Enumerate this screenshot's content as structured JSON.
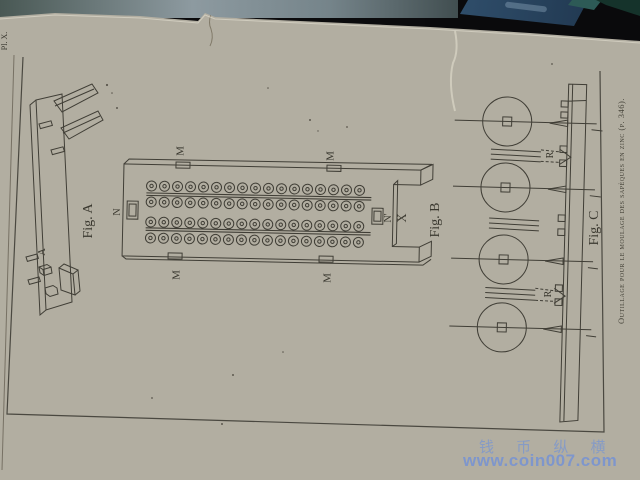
{
  "page": {
    "plate_number": "Pl. X.",
    "caption": "Outillage pour le moulage des sapèques en zinc (p. 346)."
  },
  "figures": {
    "fig_a": {
      "label": "Fig. A",
      "labels": {
        "a": "A"
      }
    },
    "fig_b": {
      "label": "Fig. B",
      "labels": {
        "m": "M",
        "n": "N",
        "n_prime": "N'",
        "x": "X"
      },
      "mold": {
        "rows": 4,
        "coins_per_row": 17
      }
    },
    "fig_c": {
      "label": "Fig. C",
      "labels": {
        "r": "R"
      },
      "coins": 4
    }
  },
  "watermark": {
    "line1": "钱 币 纵 横",
    "line2": "www.coin007.com",
    "color": "#7a96d0"
  }
}
